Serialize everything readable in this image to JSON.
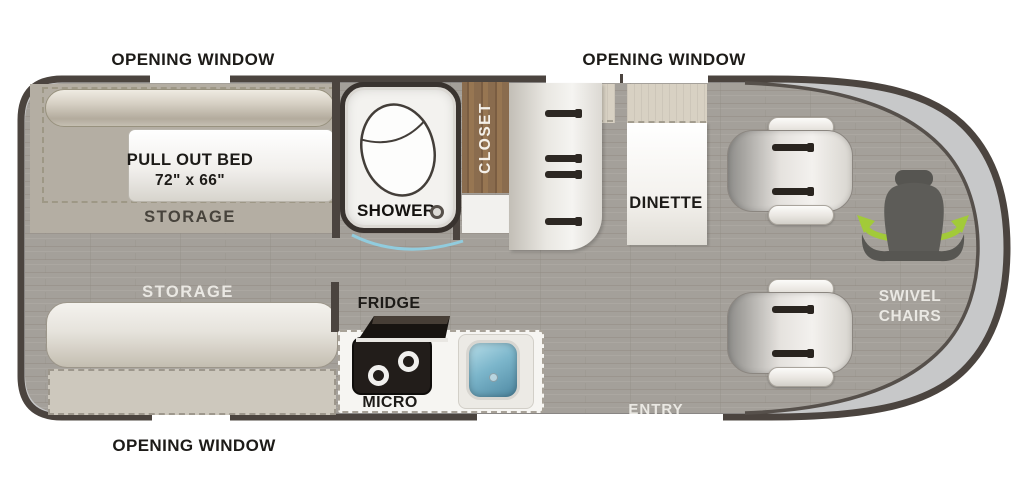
{
  "diagram": {
    "type": "rv-floorplan",
    "labels": {
      "opening_window_top_left": "OPENING WINDOW",
      "opening_window_top_right": "OPENING WINDOW",
      "opening_window_bottom": "OPENING WINDOW",
      "pull_out_bed_name": "PULL OUT BED",
      "pull_out_bed_size": "72\" x 66\"",
      "storage_rear": "STORAGE",
      "storage_front": "STORAGE",
      "shower": "SHOWER",
      "closet": "CLOSET",
      "dinette": "DINETTE",
      "fridge": "FRIDGE",
      "micro": "MICRO",
      "entry": "ENTRY",
      "swivel_line1": "SWIVEL",
      "swivel_line2": "CHAIRS"
    },
    "colors": {
      "wall": "#4b443f",
      "floor": "#a4a09a",
      "windshield": "#c7c8c9",
      "accent_green": "#a2ca39",
      "sink_blue": "#6fadc6",
      "closet_wood": "#8a6c4e",
      "door_arc_blue": "#8fd0e6"
    }
  }
}
